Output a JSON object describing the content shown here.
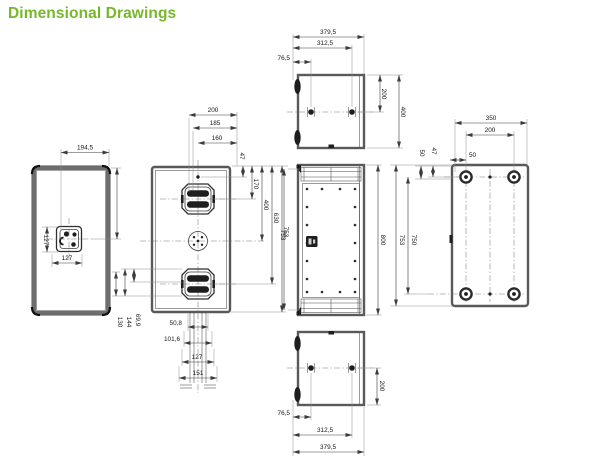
{
  "title": "Dimensional Drawings",
  "colors": {
    "accent": "#76b82a",
    "line": "#3d3d3d"
  },
  "views": {
    "side_left": {
      "width": "194,5",
      "connector_height": "127",
      "connector_width": "127"
    },
    "side_center": {
      "top": [
        "200",
        "185",
        "160"
      ],
      "offset": "47",
      "right": [
        "170",
        "400",
        "630",
        "753"
      ],
      "left": [
        "130",
        "144",
        "69,9"
      ],
      "bottom": [
        "50,8",
        "101,6",
        "127",
        "151"
      ]
    },
    "top": {
      "widths": [
        "379,5",
        "312,5",
        "76,5"
      ],
      "depths": [
        "200",
        "400"
      ]
    },
    "front": {
      "inner_height": "753",
      "outer_height": "800"
    },
    "rear": {
      "top": [
        "350",
        "200",
        "50"
      ],
      "side": [
        "50",
        "47"
      ],
      "heights": [
        "753",
        "750"
      ]
    },
    "bottom": {
      "widths": [
        "76,5",
        "312,5",
        "379,5"
      ],
      "depth": "200"
    }
  }
}
